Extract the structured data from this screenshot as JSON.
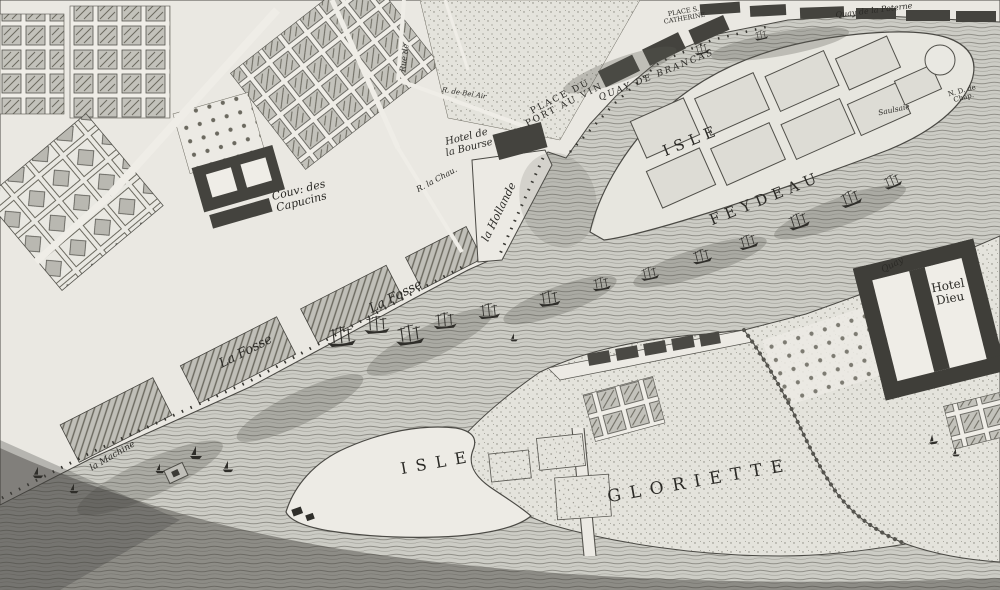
{
  "map": {
    "kind": "engraved-riverfront-city-map",
    "palette": {
      "paper": "#eae9e3",
      "ink": "#2b2a26",
      "water_base": "#cbcac4",
      "water_line": "#8f8e87",
      "block_dark": "#44433e"
    },
    "icons": {
      "ship": "three-masted-ship-icon",
      "boat": "small-sailboat-icon"
    },
    "labels": {
      "couv_des_capucins": "Couv: des\nCapucins",
      "r_la_chau": "R. la Chau.",
      "rue_de": "Rue de",
      "r_de_bel_air": "R. de Bel Air",
      "hotel_de_la_bourse": "Hotel de\nla Bourse",
      "la_hollande": "la Hollande",
      "place_du_port_au_vin": "PLACE DU\nPORT AU VIN",
      "quay_de_brancas": "QUAY DE BRANCAS",
      "place_s_catherine": "PLACE S.\nCATHERINE",
      "quay_de_la_poterne": "Quay de la Poterne",
      "isle_feydeau_line1": "ISLE",
      "isle_feydeau_line2": "FEYDEAU",
      "saulsaie": "Saulsaie",
      "nd_de_chap": "N. D. de\nChap.",
      "quay_hotel_dieu": "Quay",
      "hotel_dieu": "Hotel\nDieu",
      "la_fosse_1": "La Fosse",
      "la_fosse_2": "La Fosse",
      "la_machine": "la Machine",
      "isle": "ISLE",
      "gloriette": "GLORIETTE"
    }
  }
}
